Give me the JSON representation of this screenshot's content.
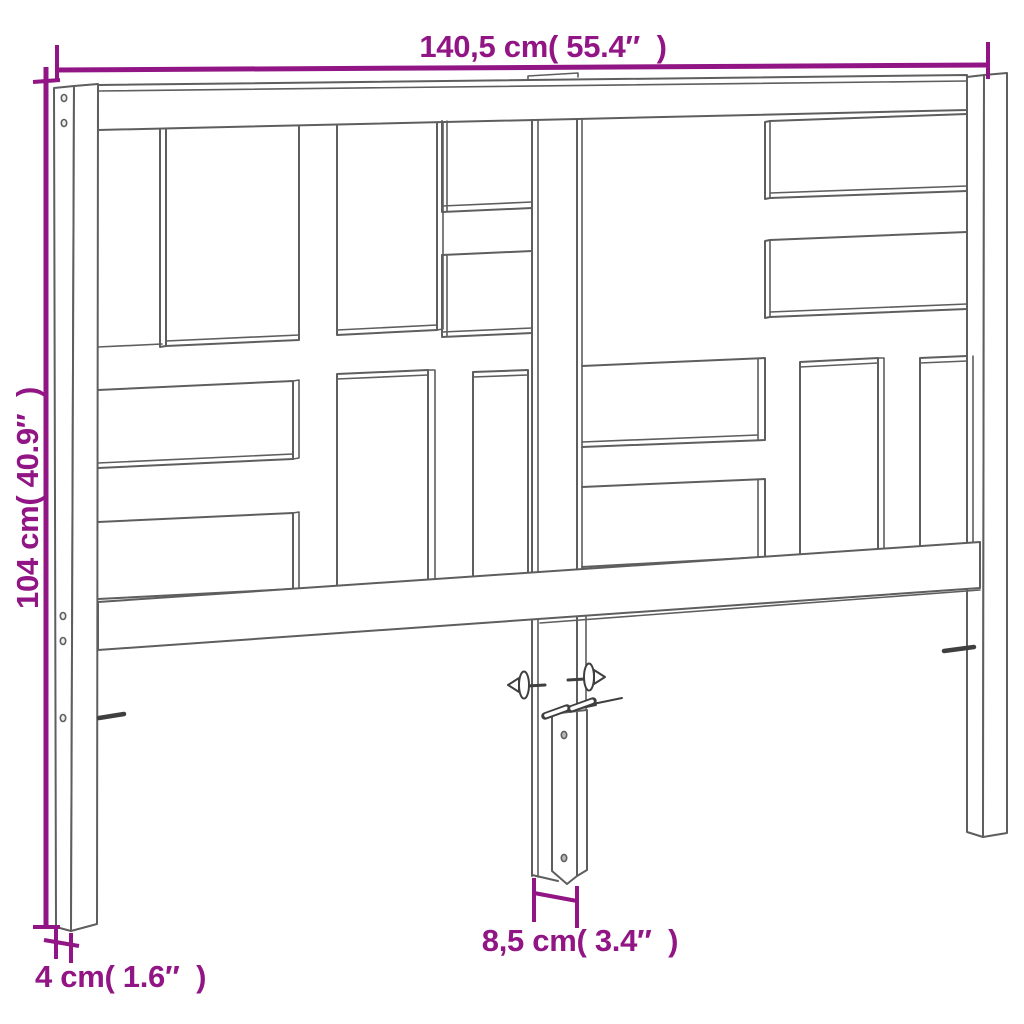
{
  "figure": {
    "title": "Headboard dimension diagram",
    "style": "technical line drawing",
    "colors": {
      "dimension": "#911584",
      "line": "#5e5e5e",
      "line_dark": "#3f3f3f",
      "background": "#ffffff"
    }
  },
  "dimensions": {
    "overall_width": {
      "label": "140,5 cm( 55.4″  )",
      "value_cm": "140,5",
      "value_in": "55.4",
      "position": "top"
    },
    "overall_height": {
      "label": "104 cm( 40.9″  )",
      "value_cm": "104",
      "value_in": "40.9",
      "position": "left"
    },
    "post_width": {
      "label": "4 cm( 1.6″  )",
      "value_cm": "4",
      "value_in": "1.6",
      "position": "bottom-left"
    },
    "bracket_width": {
      "label": "8,5 cm( 3.4″  )",
      "value_cm": "8,5",
      "value_in": "3.4",
      "position": "bottom-center"
    }
  }
}
